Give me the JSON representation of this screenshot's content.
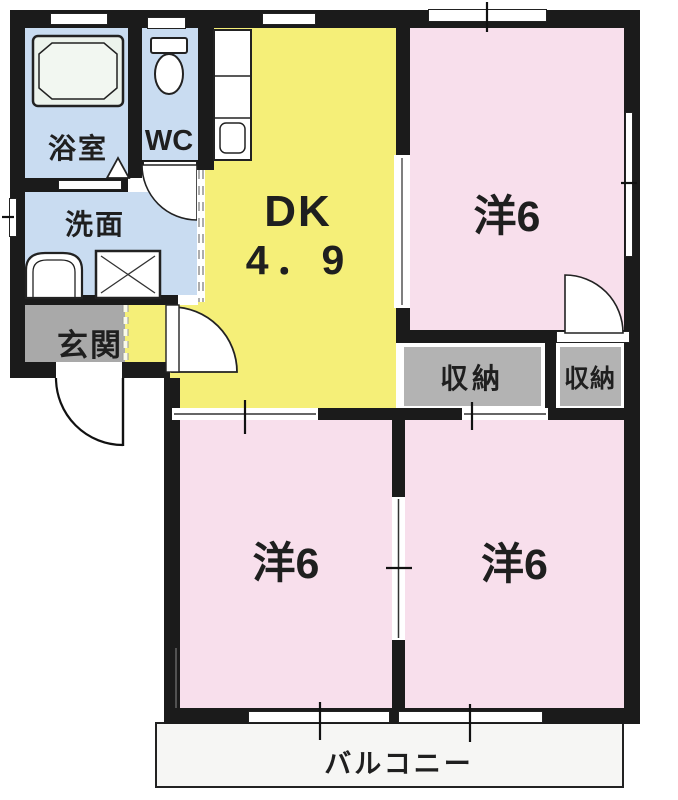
{
  "colors": {
    "wall": "#1b1b1b",
    "water_blue": "#c9dcf1",
    "kitchen_yellow": "#f5ef78",
    "room_pink": "#f8dfec",
    "entrance_gray": "#a9a9a9",
    "storage_gray": "#b3b3b3",
    "balcony_white": "#f6f6f4",
    "tub_green": "#ecf3ec",
    "text": "#1f1f1f"
  },
  "rooms": {
    "bathroom": {
      "label": "浴室"
    },
    "wc": {
      "label": "WC"
    },
    "washroom": {
      "label": "洗面"
    },
    "entrance": {
      "label": "玄関"
    },
    "dk": {
      "label": "DK",
      "size": "4．9"
    },
    "bedroom_ne": {
      "label": "洋6"
    },
    "bedroom_sw": {
      "label": "洋6"
    },
    "bedroom_se": {
      "label": "洋6"
    },
    "storage_a": {
      "label": "収納"
    },
    "storage_b": {
      "label": "収納"
    },
    "balcony": {
      "label": "バルコニー"
    }
  }
}
